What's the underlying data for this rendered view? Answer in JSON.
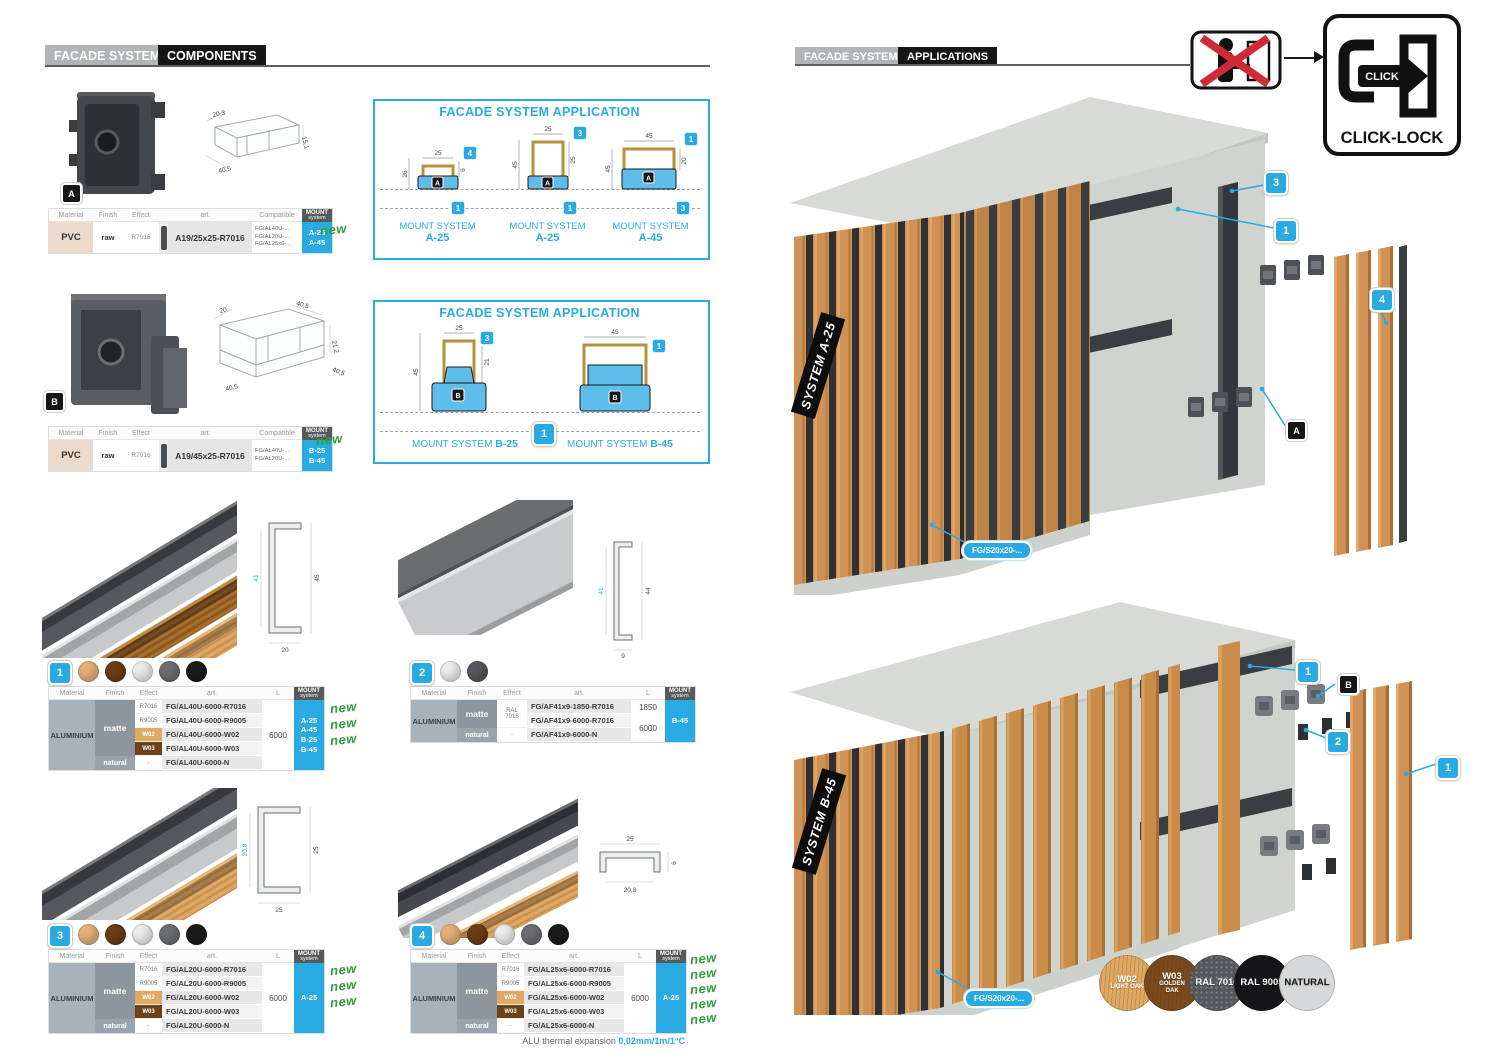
{
  "L": {
    "hdr": {
      "brand": "FACADE SYSTEM",
      "tab": "COMPONENTS"
    },
    "th": {
      "material": "Material",
      "finish": "Finish",
      "effect": "Effect",
      "art": "art.",
      "compat": "Compatible",
      "len": "L",
      "mount1": "MOUNT",
      "mount2": "system"
    },
    "ca": {
      "badge": "A",
      "iso": [
        "20,3",
        "40,5",
        "15,1"
      ],
      "t": {
        "m": "PVC",
        "f": "raw",
        "e": "R7016",
        "art": "A19/25x25-R7016",
        "c1": "FG/AL40U-...",
        "c2": "FG/AL20U-...",
        "c3": "FG/AL25x6-...",
        "m1": "A-25",
        "m2": "A-45",
        "new": "new"
      }
    },
    "cb": {
      "badge": "B",
      "iso": [
        "20",
        "40,5",
        "21,2",
        "40,5",
        "40,5"
      ],
      "t": {
        "m": "PVC",
        "f": "raw",
        "e": "R7016",
        "art": "A19/45x25-R7016",
        "c1": "FG/AL40U-...",
        "c2": "FG/AL20U-...",
        "m1": "B-25",
        "m2": "B-45",
        "new": "new"
      }
    },
    "appa": {
      "title": "FACADE SYSTEM APPLICATION",
      "cap": "MOUNT SYSTEM",
      "d": [
        {
          "sys": "A-25",
          "dt": "25",
          "dl": "26",
          "dr": "6",
          "bt": "4",
          "bb": "1",
          "p": "A"
        },
        {
          "sys": "A-25",
          "dt": "25",
          "dl": "45",
          "dr": "25",
          "bt": "3",
          "bb": "1",
          "p": "A"
        },
        {
          "sys": "A-45",
          "dt": "45",
          "dl": "45",
          "dr": "20",
          "bt": "1",
          "bb": "3",
          "p": "A"
        }
      ]
    },
    "appb": {
      "title": "FACADE SYSTEM APPLICATION",
      "cap": "MOUNT SYSTEM",
      "bb": "1",
      "d": [
        {
          "sys": "B-25",
          "dt": "25",
          "dl": "45",
          "dr": "21",
          "bt": "3",
          "p": "B"
        },
        {
          "sys": "B-45",
          "dt": "45",
          "bt": "1",
          "p": "B"
        }
      ]
    },
    "p1": {
      "num": "1",
      "dots": [
        "#e4b077",
        "#6b3d16",
        "#ebebeb",
        "#6d6e71",
        "#1b1b1d"
      ],
      "cs": [
        "41",
        "45",
        "20"
      ],
      "mat": "ALUMINIUM",
      "fm": "matte",
      "fn": "natural",
      "e": [
        "R7016",
        "R9005",
        "W02",
        "W03",
        "-"
      ],
      "a": [
        "FG/AL40U-6000-R7016",
        "FG/AL40U-6000-R9005",
        "FG/AL40U-6000-W02",
        "FG/AL40U-6000-W03",
        "FG/AL40U-6000-N"
      ],
      "len": "6000",
      "mount": [
        "A-25",
        "A-45",
        "B-25",
        "B-45"
      ],
      "news": [
        "new",
        "new",
        "new"
      ]
    },
    "p2": {
      "num": "2",
      "dots": [
        "#ebebeb",
        "#55595d"
      ],
      "cs": [
        "41",
        "44",
        "9"
      ],
      "mat": "ALUMINIUM",
      "fm": "matte",
      "fn": "natural",
      "e1a": "RAL",
      "e1b": "7016",
      "e3": "-",
      "a": [
        "FG/AF41x9-1850-R7016",
        "FG/AF41x9-6000-R7016",
        "FG/AF41x9-6000-N"
      ],
      "len1": "1850",
      "len2": "6000",
      "mount": [
        "B-45"
      ]
    },
    "p3": {
      "num": "3",
      "dots": [
        "#e4b077",
        "#6b3d16",
        "#ebebeb",
        "#6d6e71",
        "#1b1b1d"
      ],
      "cs": [
        "20,8",
        "25",
        "25"
      ],
      "mat": "ALUMINIUM",
      "fm": "matte",
      "fn": "natural",
      "e": [
        "R7016",
        "R9005",
        "W02",
        "W03",
        "-"
      ],
      "a": [
        "FG/AL20U-6000-R7016",
        "FG/AL20U-6000-R9005",
        "FG/AL20U-6000-W02",
        "FG/AL20U-6000-W03",
        "FG/AL20U-6000-N"
      ],
      "len": "6000",
      "mount": [
        "A-25"
      ],
      "news": [
        "new",
        "new",
        "new"
      ]
    },
    "p4": {
      "num": "4",
      "dots": [
        "#e4b077",
        "#6b3d16",
        "#ebebeb",
        "#6d6e71",
        "#1b1b1d"
      ],
      "cs": [
        "25",
        "6",
        "20,8"
      ],
      "mat": "ALUMINIUM",
      "fm": "matte",
      "fn": "natural",
      "e": [
        "R7016",
        "R9005",
        "W02",
        "W03",
        "-"
      ],
      "a": [
        "FG/AL25x6-6000-R7016",
        "FG/AL25x6-6000-R9005",
        "FG/AL25x6-6000-W02",
        "FG/AL25x6-6000-W03",
        "FG/AL25x6-6000-N"
      ],
      "len": "6000",
      "mount": [
        "A-25"
      ],
      "news": [
        "new",
        "new",
        "new",
        "new",
        "new"
      ]
    },
    "foot": {
      "label": "ALU thermal expansion",
      "value": "0,02mm/1m/1°C"
    }
  },
  "R": {
    "hdr": {
      "brand": "FACADE SYSTEM",
      "tab": "APPLICATIONS"
    },
    "cl": {
      "click": "CLICK",
      "label": "CLICK-LOCK"
    },
    "ra": {
      "sys": "SYSTEM A-25",
      "part": "FG/S20x20-...",
      "b3": "3",
      "b1": "1",
      "b4": "4",
      "ba": "A"
    },
    "rb": {
      "sys": "SYSTEM B-45",
      "part": "FG/S20x20-...",
      "b1": "1",
      "bb": "B",
      "b2": "2",
      "b1s": "1"
    },
    "sw": [
      {
        "code": "W02",
        "name": "LIGHT OAK",
        "bg": "#dfa963",
        "fg": "#ffffff"
      },
      {
        "code": "W03",
        "name": "GOLDEN OAK",
        "bg": "#7a4a1e",
        "fg": "#ffffff"
      },
      {
        "code": "RAL 7016",
        "name": "",
        "bg": "#54575b",
        "fg": "#ffffff"
      },
      {
        "code": "RAL 9005",
        "name": "",
        "bg": "#161618",
        "fg": "#ffffff"
      },
      {
        "code": "NATURAL",
        "name": "",
        "bg": "#d7d8d9",
        "fg": "#1a1a1a"
      }
    ]
  },
  "colors": {
    "accent": "#29abe2",
    "new_green": "#2f9e3f"
  }
}
